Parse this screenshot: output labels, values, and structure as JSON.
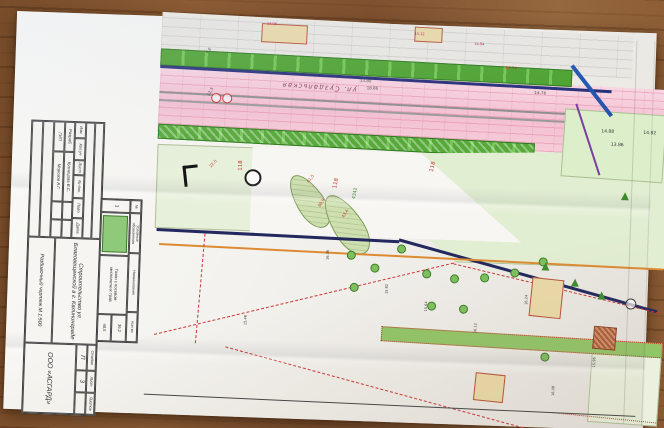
{
  "stamp": {
    "code": "085-04-23.2",
    "header": [
      "Изм.",
      "Кол.уч",
      "Лист",
      "№ док.",
      "Подп.",
      "Дата"
    ],
    "rows": [
      {
        "role": "Разраб.",
        "name": "Кузнецова В.С."
      },
      {
        "role": "ГИП",
        "name": "Морозов А.Г."
      }
    ],
    "title": "Строительство ул. Благовещенской в г. Калининграде",
    "doc_name": "Разбивочный чертеж М 1:500",
    "stage_label": "Стадия",
    "stage": "П",
    "sheet_label": "Лист",
    "sheet": "3",
    "sheets_label": "Листов",
    "org": "ООО «АСГАРД»"
  },
  "legend": {
    "num_header": "№",
    "col_symbol": "Условные обозначения",
    "col_name": "Наименование",
    "col_qty": "Кол-во",
    "row_num": "1",
    "row_name": "Газон с посевом многолетних трав",
    "qty1": "36,2",
    "qty2": "48,5",
    "swatch_color": "#8fc97a"
  },
  "plan": {
    "street": "ул. Суздальская",
    "annotations": [
      {
        "t": "13.80",
        "x": 345,
        "y": 56,
        "r": 0,
        "c": "#444",
        "s": 4
      },
      {
        "t": "18.86",
        "x": 352,
        "y": 63,
        "r": 0,
        "c": "#444",
        "s": 4
      },
      {
        "t": "16.74",
        "x": 490,
        "y": 38,
        "r": 0,
        "c": "#c0392b",
        "s": 4
      },
      {
        "t": "14.76",
        "x": 520,
        "y": 62,
        "r": 0,
        "c": "#444",
        "s": 4
      },
      {
        "t": "14.88",
        "x": 588,
        "y": 99,
        "r": 0,
        "c": "#333",
        "s": 4.5
      },
      {
        "t": "14.82",
        "x": 630,
        "y": 99,
        "r": 0,
        "c": "#333",
        "s": 4.5
      },
      {
        "t": "13.86",
        "x": 598,
        "y": 112,
        "r": 0,
        "c": "#333",
        "s": 4.5
      },
      {
        "t": "118",
        "x": 227,
        "y": 152,
        "r": -90,
        "c": "#c0392b",
        "s": 5.5
      },
      {
        "t": "118",
        "x": 418,
        "y": 146,
        "r": -78,
        "c": "#c0392b",
        "s": 5.5
      },
      {
        "t": "118",
        "x": 322,
        "y": 166,
        "r": -80,
        "c": "#c0392b",
        "s": 5.5
      },
      {
        "t": "4342",
        "x": 342,
        "y": 176,
        "r": -80,
        "c": "#2e7d32",
        "s": 4.5
      },
      {
        "t": "61,5",
        "x": 295,
        "y": 160,
        "r": -55,
        "c": "#c0392b",
        "s": 4
      },
      {
        "t": "60,9",
        "x": 307,
        "y": 184,
        "r": -60,
        "c": "#c0392b",
        "s": 4
      },
      {
        "t": "43,4",
        "x": 331,
        "y": 194,
        "r": -60,
        "c": "#c0392b",
        "s": 4
      },
      {
        "t": "22,5",
        "x": 197,
        "y": 148,
        "r": -50,
        "c": "#c0392b",
        "s": 4
      },
      {
        "t": "4,6",
        "x": 189,
        "y": 34,
        "r": -45,
        "c": "#444",
        "s": 4
      },
      {
        "t": "12,3",
        "x": 192,
        "y": 77,
        "r": -60,
        "c": "#444",
        "s": 4
      },
      {
        "t": "14.06",
        "x": 250,
        "y": 3,
        "r": 0,
        "c": "#c06",
        "s": 3.5
      },
      {
        "t": "15.12",
        "x": 398,
        "y": 8,
        "r": 0,
        "c": "#c06",
        "s": 3.5
      },
      {
        "t": "14.94",
        "x": 458,
        "y": 16,
        "r": 0,
        "c": "#c06",
        "s": 3.5
      },
      {
        "t": "16.36",
        "x": 318,
        "y": 238,
        "r": -90,
        "c": "#333",
        "s": 3.5
      },
      {
        "t": "15.82",
        "x": 378,
        "y": 270,
        "r": -90,
        "c": "#333",
        "s": 3.5
      },
      {
        "t": "15.64",
        "x": 418,
        "y": 286,
        "r": -90,
        "c": "#333",
        "s": 3.5
      },
      {
        "t": "16.12",
        "x": 468,
        "y": 306,
        "r": -90,
        "c": "#333",
        "s": 3.5
      },
      {
        "t": "15.48",
        "x": 238,
        "y": 306,
        "r": -90,
        "c": "#333",
        "s": 3.5
      },
      {
        "t": "16.24",
        "x": 518,
        "y": 276,
        "r": -90,
        "c": "#333",
        "s": 3.5
      },
      {
        "t": "15.96",
        "x": 588,
        "y": 336,
        "r": -90,
        "c": "#333",
        "s": 3.5
      },
      {
        "t": "16.08",
        "x": 548,
        "y": 366,
        "r": -90,
        "c": "#333",
        "s": 3.5
      }
    ]
  },
  "colors": {
    "road_pink": "#f5c9d8",
    "lawn_green": "#5fb43e",
    "utility_navy": "#27307a",
    "utility_blue": "#2456b0",
    "utility_orange": "#dd8a33",
    "fence_red": "#cc3333",
    "wood": "#8d5d36"
  }
}
